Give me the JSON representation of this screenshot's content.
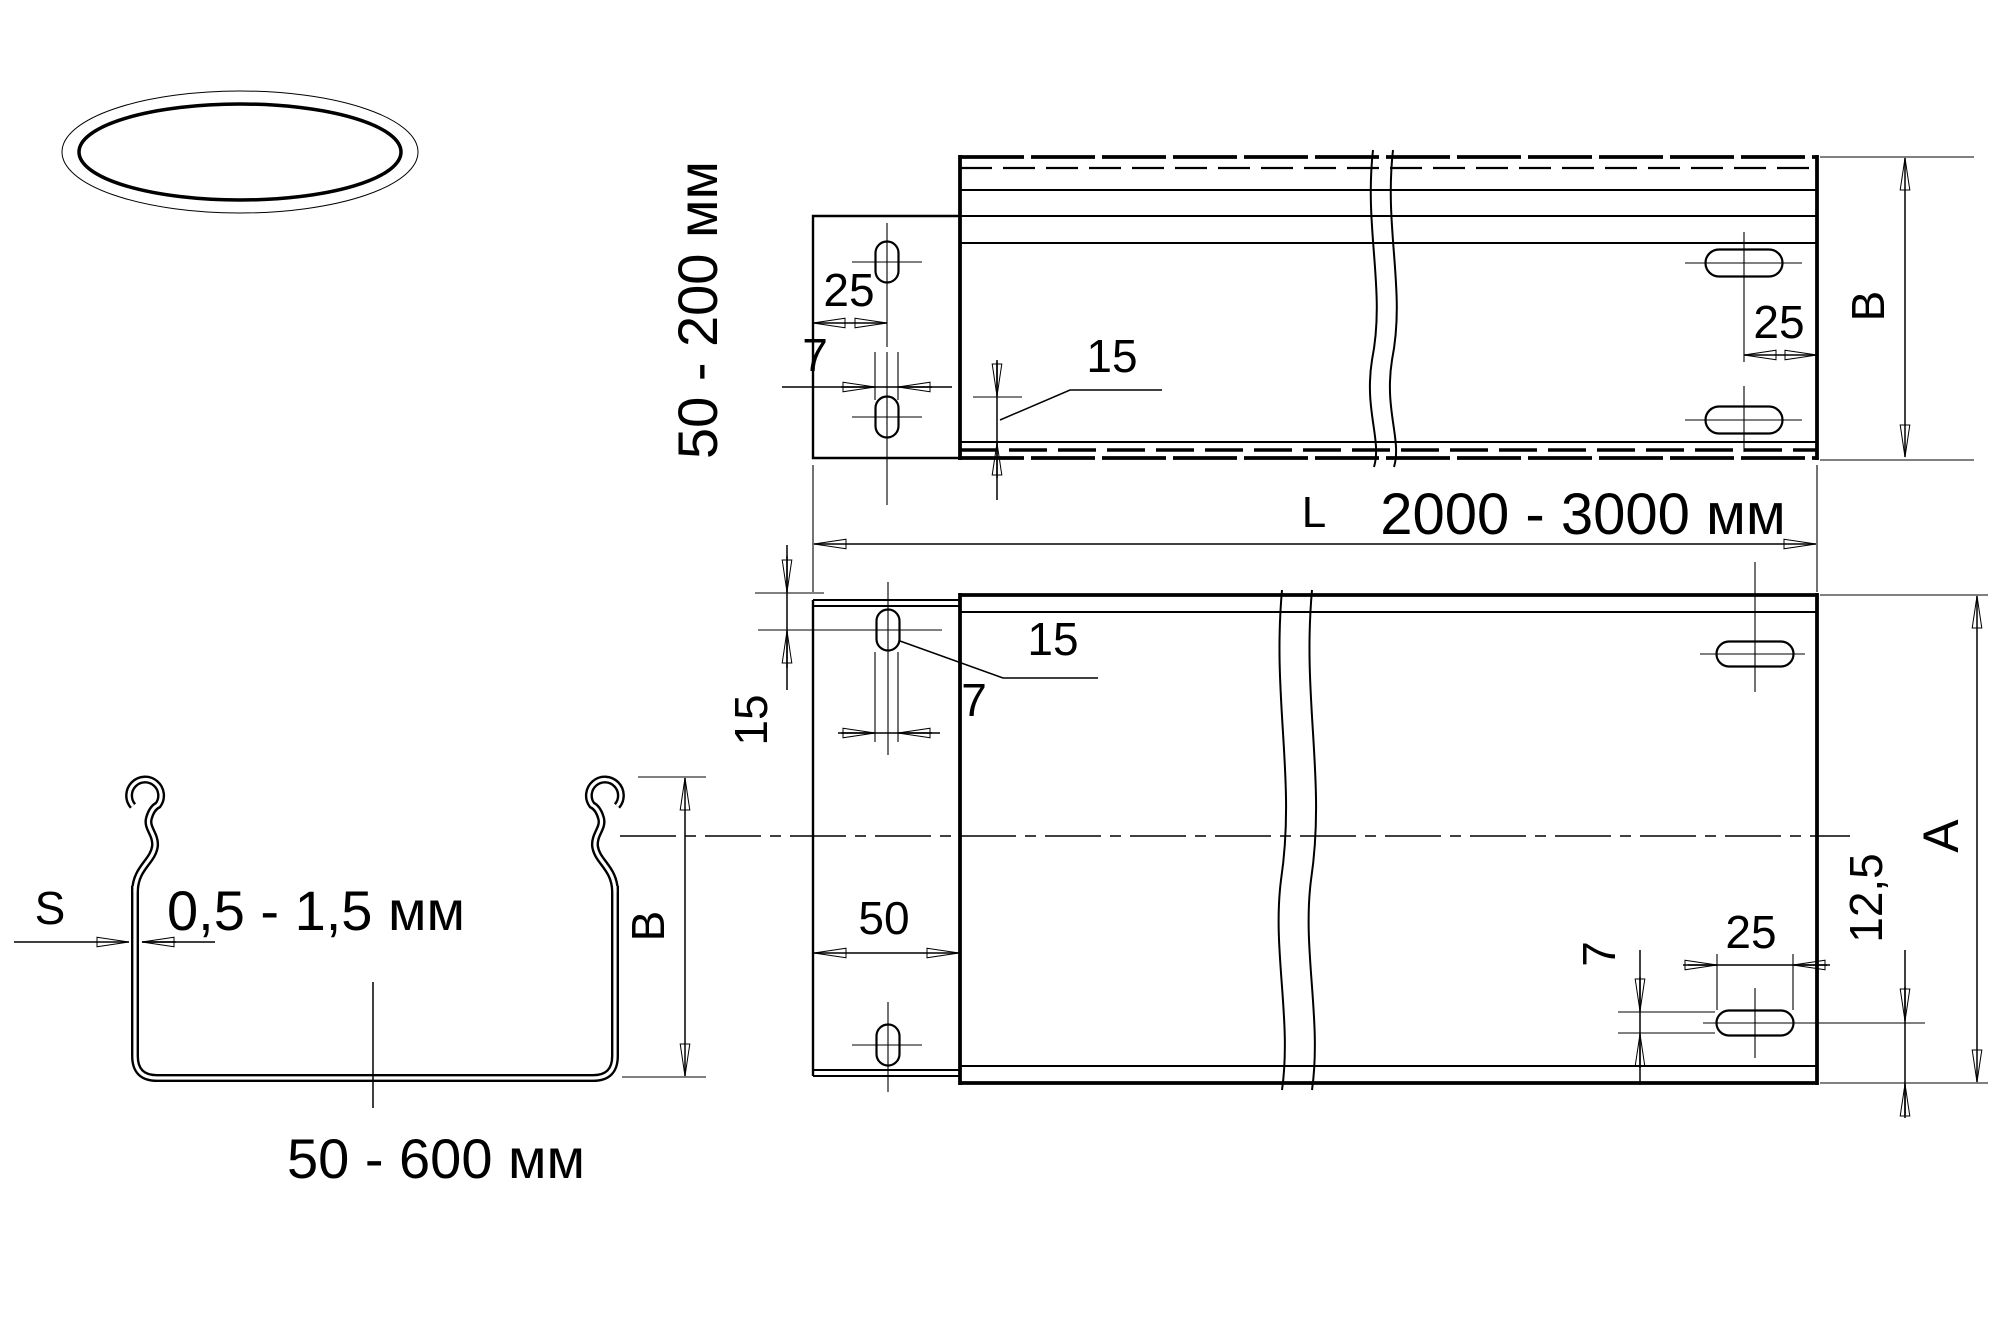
{
  "logo": {
    "text": "СОЭМИ",
    "bg_color": "#3b67b5",
    "text_color": "#ffffff"
  },
  "side_view": {
    "height_range_label": "50 - 200 мм",
    "dim_plate_edge_to_slot": "25",
    "dim_plate_slot_width": "7",
    "dim_flange_leader": "15",
    "dim_slot_to_end": "25",
    "height_letter": "B"
  },
  "length_dim": {
    "letter": "L",
    "range": "2000 - 3000 мм"
  },
  "plan_view": {
    "dim_end_to_slot": "15",
    "dim_slot_leader": "15",
    "dim_slot_width": "7",
    "dim_plate_depth": "50",
    "dim_slot_height": "7",
    "dim_slot_length": "25",
    "dim_slot_center_to_edge": "12,5",
    "width_letter": "A"
  },
  "section_view": {
    "thickness_letter": "S",
    "thickness_range": "0,5 - 1,5 мм",
    "height_letter": "B",
    "width_range": "50 - 600 мм"
  }
}
